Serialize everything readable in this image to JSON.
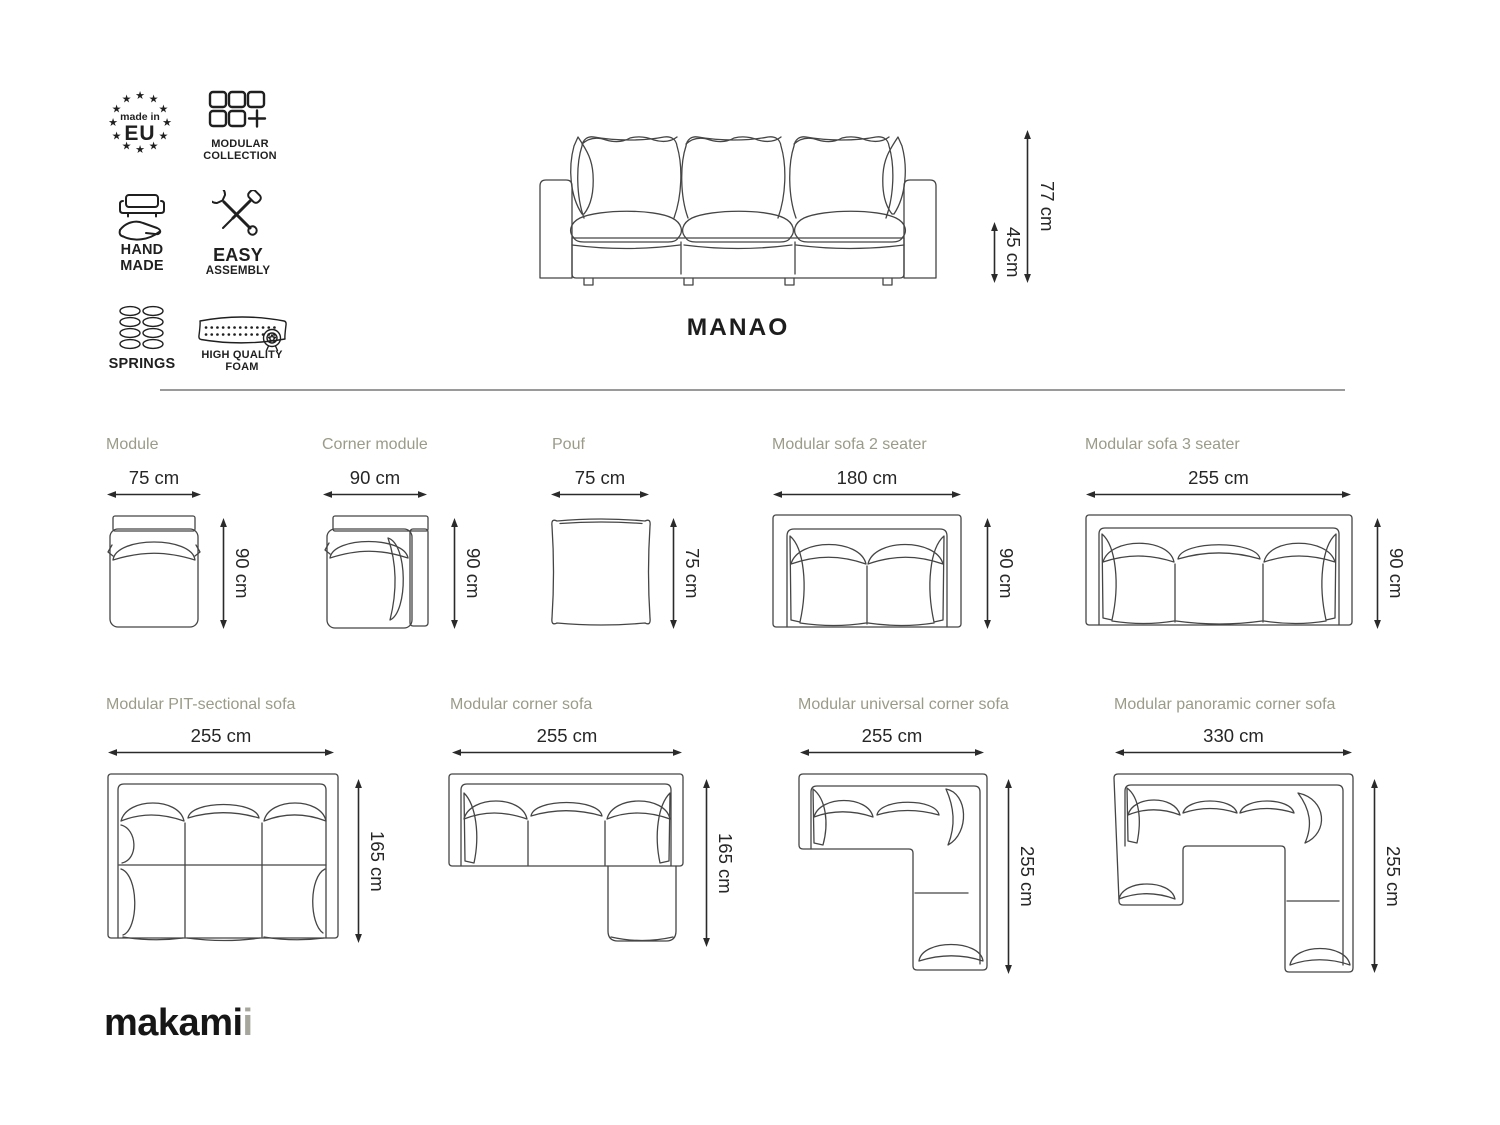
{
  "badges": {
    "made_in_eu": {
      "star": "★",
      "line1": "made in",
      "line2": "EU"
    },
    "modular_collection": {
      "line1": "MODULAR",
      "line2": "COLLECTION"
    },
    "hand_made": {
      "line1": "HAND",
      "line2": "MADE"
    },
    "easy_assembly": {
      "line1": "EASY",
      "line2": "ASSEMBLY"
    },
    "springs": {
      "label": "SPRINGS"
    },
    "high_quality_foam": {
      "line1": "HIGH QUALITY",
      "line2": "FOAM"
    }
  },
  "hero": {
    "title": "MANAO",
    "overall_height": "77 cm",
    "seat_height": "45 cm"
  },
  "diagrams": [
    {
      "title": "Module",
      "width": "75 cm",
      "height": "90 cm"
    },
    {
      "title": "Corner module",
      "width": "90 cm",
      "height": "90 cm"
    },
    {
      "title": "Pouf",
      "width": "75 cm",
      "height": "75 cm"
    },
    {
      "title": "Modular sofa 2 seater",
      "width": "180 cm",
      "height": "90 cm"
    },
    {
      "title": "Modular sofa 3 seater",
      "width": "255 cm",
      "height": "90 cm"
    },
    {
      "title": "Modular PIT-sectional sofa",
      "width": "255 cm",
      "height": "165 cm"
    },
    {
      "title": "Modular corner sofa",
      "width": "255 cm",
      "height": "165 cm"
    },
    {
      "title": "Modular universal corner sofa",
      "width": "255 cm",
      "height": "255 cm"
    },
    {
      "title": "Modular panoramic corner sofa",
      "width": "330 cm",
      "height": "255 cm"
    }
  ],
  "logo": {
    "main": "makami",
    "accent": "i"
  },
  "colors": {
    "label_sage": "#9b9b88",
    "line_art": "#454545",
    "dimension_text": "#262626",
    "logo_accent": "#a6a69c"
  }
}
